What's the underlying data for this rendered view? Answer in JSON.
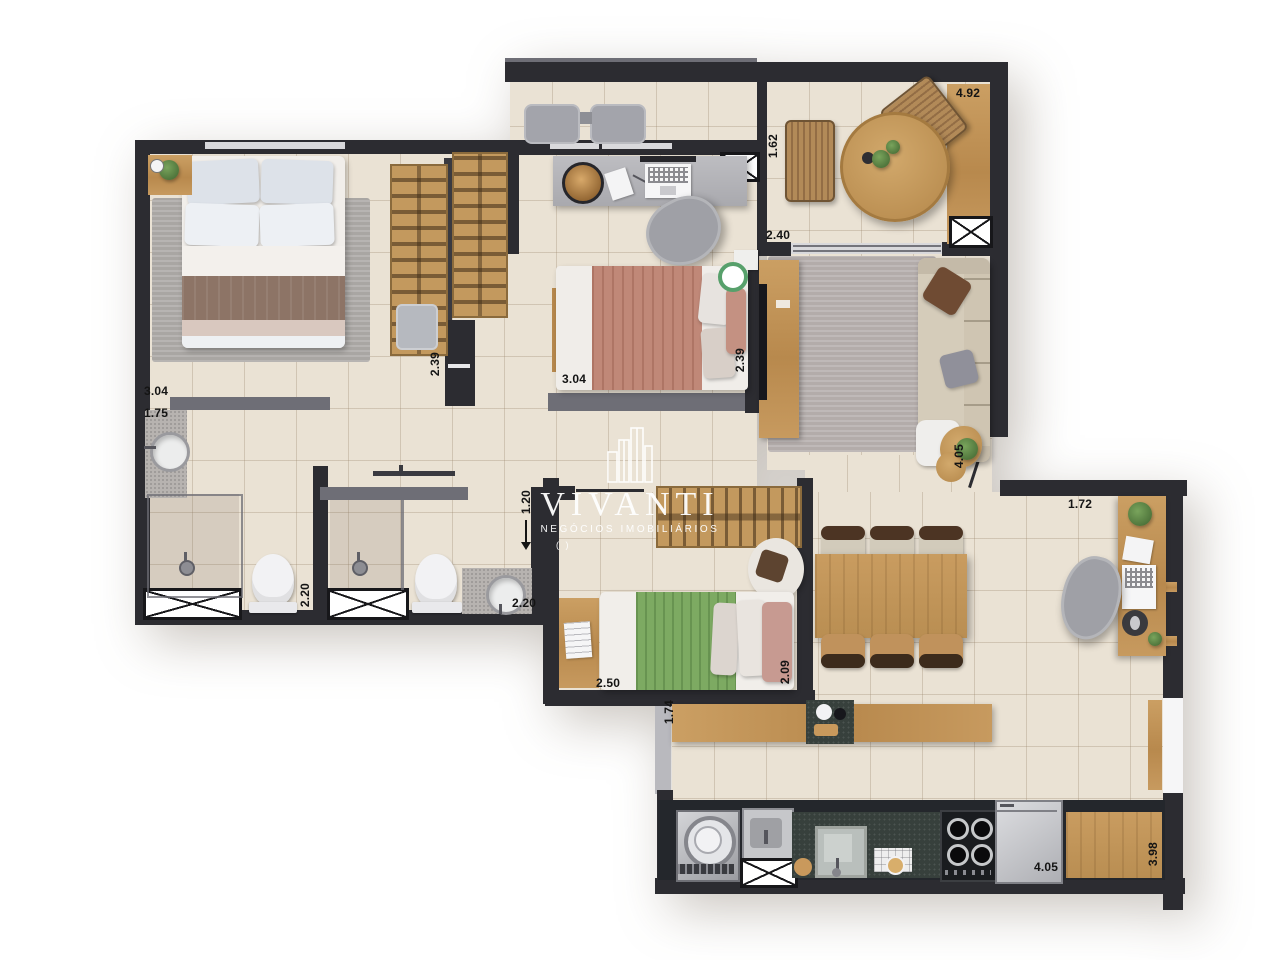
{
  "watermark": {
    "brand": "VIVANTI",
    "tagline": "NEGÓCIOS IMOBILIÁRIOS",
    "mark": "( )"
  },
  "dims": {
    "terrace_deck": "4.92",
    "balcony_depth": "1.62",
    "terrace_width": "2.40",
    "master_width": "3.04",
    "ensuite_width": "1.75",
    "closet_depth": "2.39",
    "bedroom2_width": "3.04",
    "bedroom2_depth": "2.39",
    "hall_depth": "4.05",
    "desk_width": "1.72",
    "corridor_width": "1.20",
    "bath1_depth": "2.20",
    "bath2_width": "2.20",
    "bedroom3_width": "2.50",
    "bedroom3_depth": "2.09",
    "counter_depth": "1.74",
    "kitchen_width": "4.05",
    "kitchen_depth": "3.98"
  },
  "colors": {
    "wall": "#2c2c31",
    "wall_light": "#6e6e76",
    "floor": "#eae2d4",
    "wood": "#c3985c",
    "granite": "#37403c",
    "rug": "#b3acaa",
    "sofa": "#d5ccba",
    "bed_green": "#7daa62",
    "bed_salmon": "#c08878",
    "watermark": "#ffffff"
  }
}
